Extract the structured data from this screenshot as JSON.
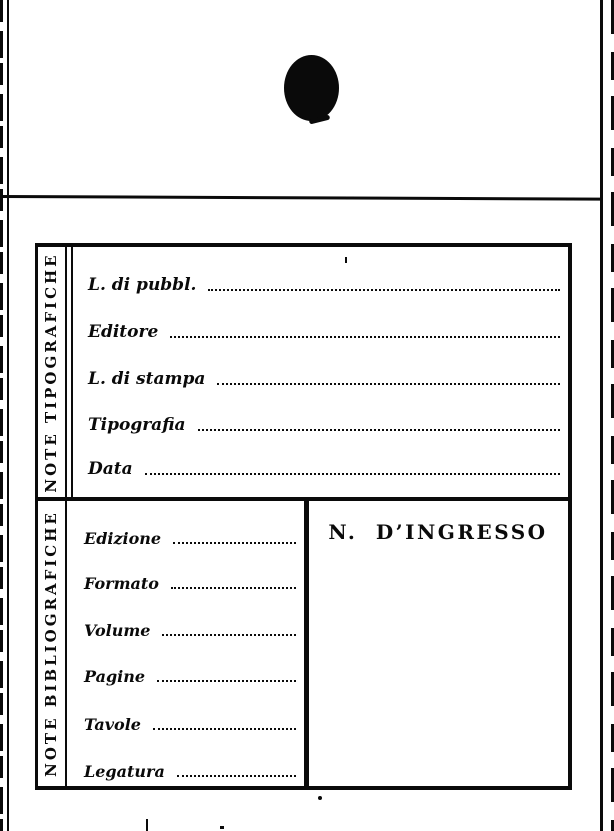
{
  "page": {
    "paper_color": "#ffffff",
    "ink_color": "#0a0a0a"
  },
  "card": {
    "typographic": {
      "side_label": "NOTE TIPOGRAFICHE",
      "fields": [
        {
          "label": "L. di pubbl.",
          "value": ""
        },
        {
          "label": "Editore",
          "value": ""
        },
        {
          "label": "L. di stampa",
          "value": ""
        },
        {
          "label": "Tipografia",
          "value": ""
        },
        {
          "label": "Data",
          "value": ""
        }
      ]
    },
    "bibliographic": {
      "side_label": "NOTE BIBLIOGRAFICHE",
      "fields": [
        {
          "label": "Edizione",
          "value": ""
        },
        {
          "label": "Formato",
          "value": ""
        },
        {
          "label": "Volume",
          "value": ""
        },
        {
          "label": "Pagine",
          "value": ""
        },
        {
          "label": "Tavole",
          "value": ""
        },
        {
          "label": "Legatura",
          "value": ""
        }
      ]
    },
    "ingresso": {
      "title": "N. D’INGRESSO"
    }
  }
}
